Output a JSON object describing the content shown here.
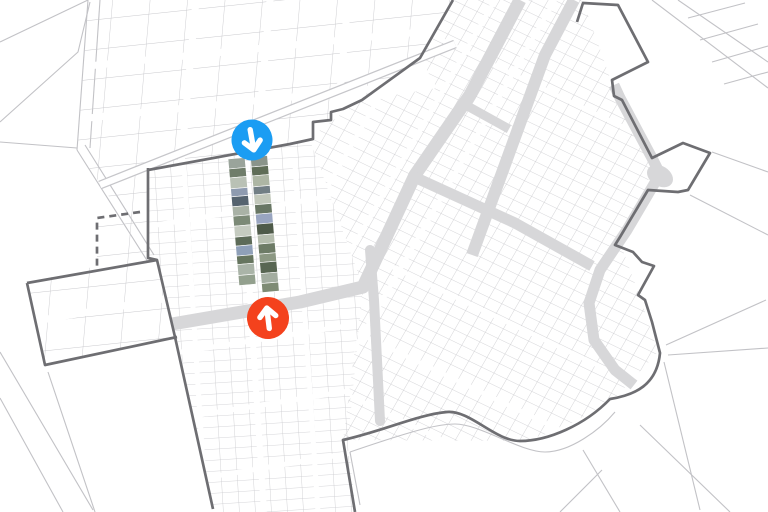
{
  "map": {
    "background_color": "#ffffff",
    "parcel_line_color": "#c9c9cd",
    "outside_line_color": "#c2c2c6",
    "road_fill_color": "#d7d7d9",
    "street_color": "#ffffff",
    "boundary_color": "#6e6e72",
    "markers": {
      "blue": {
        "color": "#1b9df3",
        "icon": "arrow-down",
        "x": 252,
        "y": 140,
        "radius": 20.5
      },
      "orange": {
        "color": "#f4421d",
        "icon": "arrow-up",
        "x": 268,
        "y": 318,
        "radius": 21
      }
    },
    "imagery_strip": {
      "x": 228,
      "y": 159,
      "rotation_deg": -5,
      "tile_width": 17,
      "gap": 5.5,
      "tile_heights": [
        10,
        9,
        11,
        8,
        10,
        9.5,
        10,
        11,
        9,
        10,
        8.5,
        11,
        10,
        9,
        10
      ],
      "columns": [
        {
          "tiles": [
            "#9aa49b",
            "#6f7d6a",
            "#b9c1b5",
            "#8e9bb0",
            "#55636f",
            "#a9b2a6",
            "#7c8a77",
            "#c5cbc0",
            "#5d6b58",
            "#8fa0b8",
            "#66755f",
            "#aab4a8",
            "#93a08e"
          ]
        },
        {
          "tiles": [
            "#8a948a",
            "#5f6d57",
            "#adb6a4",
            "#727f85",
            "#c2c8bb",
            "#687664",
            "#99a5c0",
            "#4e5a49",
            "#b5bdae",
            "#6d7b66",
            "#8c9883",
            "#586652",
            "#a3ada0",
            "#7e8b74"
          ]
        }
      ]
    }
  }
}
